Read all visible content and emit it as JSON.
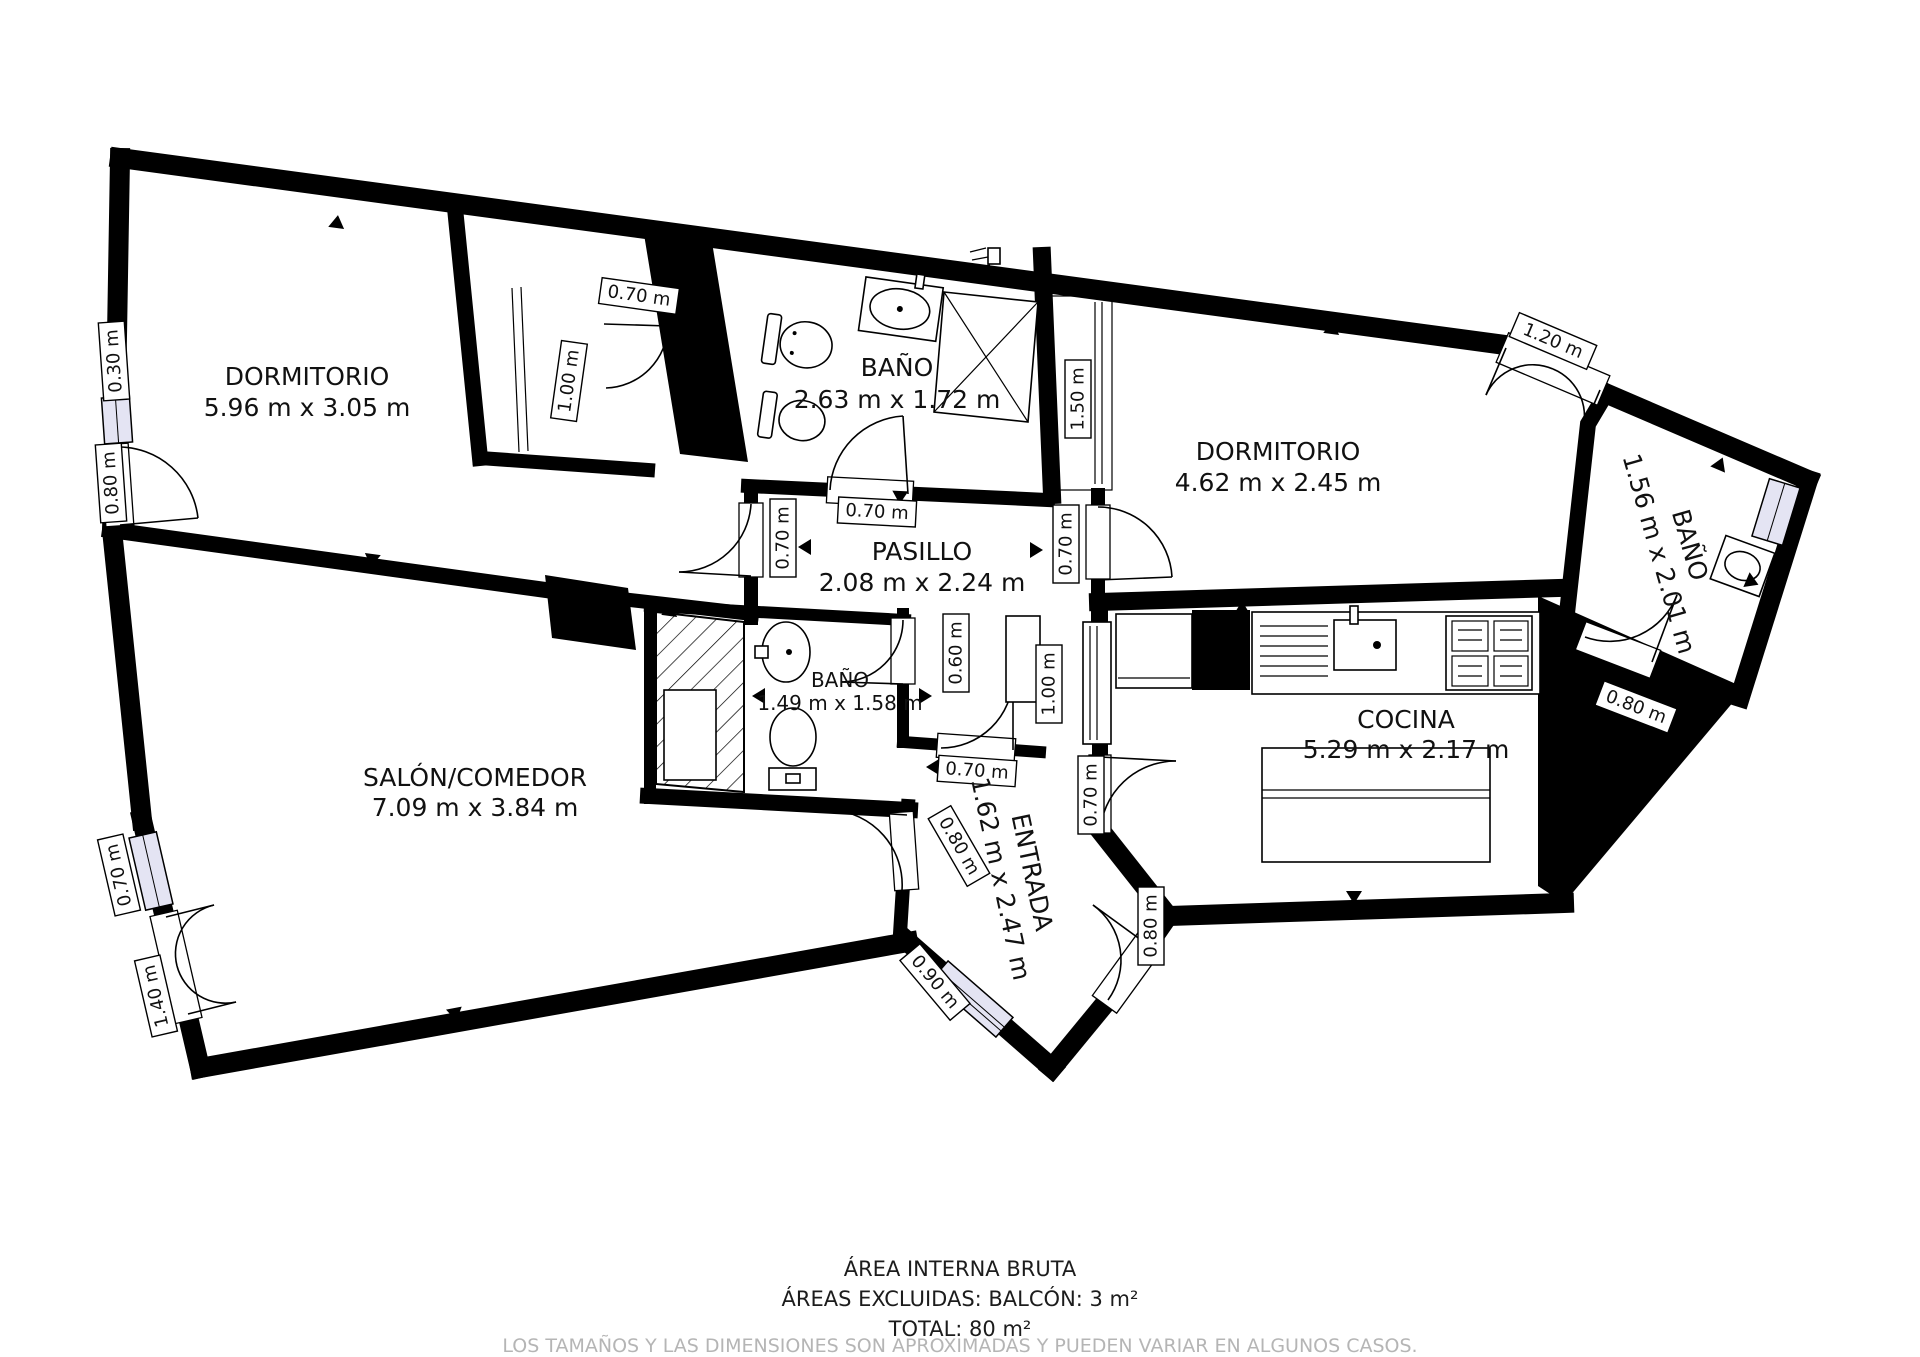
{
  "rooms": [
    {
      "id": "dormitorio-1",
      "name": "DORMITORIO",
      "dims": "5.96 m x 3.05 m"
    },
    {
      "id": "bano-principal",
      "name": "BAÑO",
      "dims": "2.63 m x 1.72 m"
    },
    {
      "id": "dormitorio-2",
      "name": "DORMITORIO",
      "dims": "4.62 m x 2.45 m"
    },
    {
      "id": "bano-derecho",
      "name": "BAÑO",
      "dims": "1.56 m x 2.01 m"
    },
    {
      "id": "pasillo",
      "name": "PASILLO",
      "dims": "2.08 m x 2.24 m"
    },
    {
      "id": "bano-pequeno",
      "name": "BAÑO",
      "dims": "1.49 m x 1.58 m"
    },
    {
      "id": "salon-comedor",
      "name": "SALÓN/COMEDOR",
      "dims": "7.09 m x 3.84 m"
    },
    {
      "id": "cocina",
      "name": "COCINA",
      "dims": "5.29 m x 2.17 m"
    },
    {
      "id": "entrada",
      "name": "ENTRADA",
      "dims": "1.62 m x 2.47 m"
    }
  ],
  "measurements": {
    "closet1_door": "0.70 m",
    "closet1_depth": "1.00 m",
    "window_030": "0.30 m",
    "door_left_080": "0.80 m",
    "bano1_door": "0.70 m",
    "closet2": "1.50 m",
    "dorm2_balcony_door": "1.20 m",
    "pasillo_salon_door": "0.70 m",
    "dorm2_door": "0.70 m",
    "pasillo_opening": "0.60 m",
    "entrada_closet": "1.00 m",
    "entrada_top_door": "0.70 m",
    "salon_entrada_door": "0.80 m",
    "cocina_door": "0.70 m",
    "entry_door": "0.80 m",
    "entrada_window": "0.90 m",
    "salon_window": "0.70 m",
    "balcony_door": "1.40 m",
    "bano2_door": "0.80 m"
  },
  "footer": {
    "line1": "ÁREA INTERNA BRUTA",
    "line2": "ÁREAS EXCLUIDAS: BALCÓN: 3 m²",
    "line3": "TOTAL: 80 m²",
    "disclaimer": "LOS TAMAÑOS Y LAS DIMENSIONES SON APROXIMADAS Y PUEDEN VARIAR EN ALGUNOS CASOS."
  },
  "colors": {
    "wall": "#000000",
    "background": "#ffffff",
    "window_glass": "#e4e4f3",
    "disclaimer_text": "#b5b5b5"
  }
}
